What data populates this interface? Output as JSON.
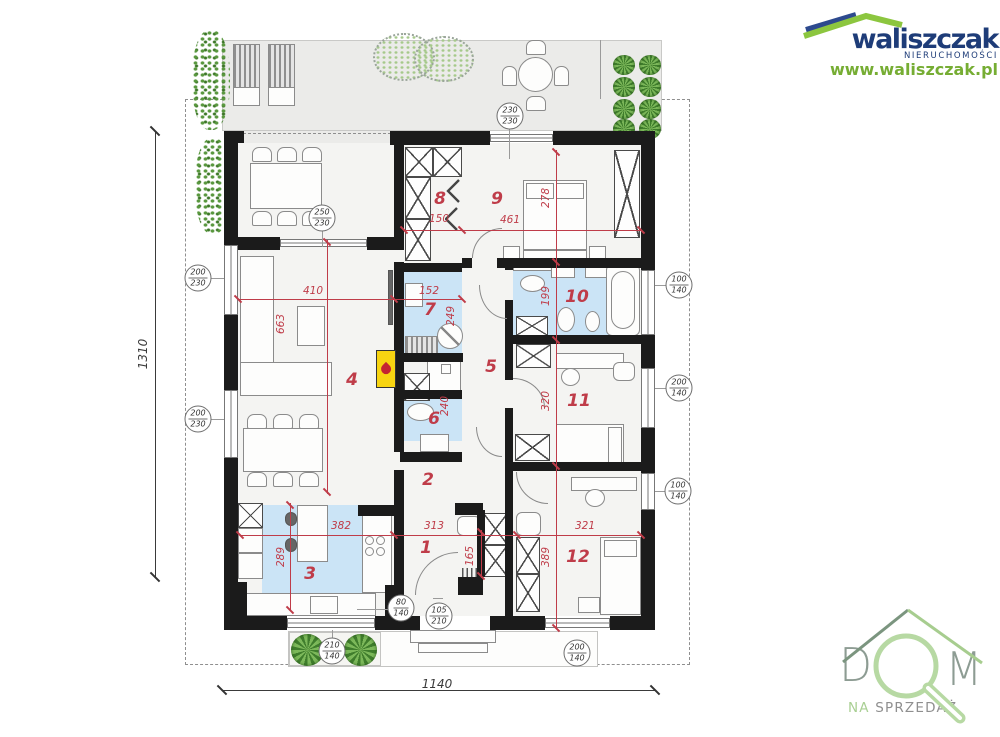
{
  "branding": {
    "name": "waliszczak",
    "tagline": "NIERUCHOMOŚCI",
    "website": "www.waliszczak.pl",
    "colors": {
      "navy": "#1e3c78",
      "green": "#76ad33",
      "roof_blue": "#2d4a8e",
      "roof_green": "#8cc63f"
    }
  },
  "watermark": {
    "letter_d": "D",
    "letter_m": "M",
    "word_na": "NA ",
    "word_sprzedaz": "SPRZEDAŻ",
    "colors": {
      "letters": "#8d9c93",
      "ring": "#b7d9a3",
      "roof_left": "#7b957f",
      "roof_right": "#a7cd8f"
    }
  },
  "plan": {
    "accent_red": "#bf3c49",
    "wet_room_blue": "#cbe4f6",
    "overall": {
      "width_cm": "1140",
      "height_cm": "1310"
    },
    "room_numbers": [
      {
        "n": "1",
        "x": 426,
        "y": 548
      },
      {
        "n": "2",
        "x": 428,
        "y": 480
      },
      {
        "n": "3",
        "x": 310,
        "y": 574
      },
      {
        "n": "4",
        "x": 352,
        "y": 380
      },
      {
        "n": "5",
        "x": 491,
        "y": 367
      },
      {
        "n": "6",
        "x": 434,
        "y": 419
      },
      {
        "n": "7",
        "x": 430,
        "y": 310
      },
      {
        "n": "8",
        "x": 440,
        "y": 199
      },
      {
        "n": "9",
        "x": 497,
        "y": 199
      },
      {
        "n": "10",
        "x": 577,
        "y": 297
      },
      {
        "n": "11",
        "x": 579,
        "y": 401
      },
      {
        "n": "12",
        "x": 578,
        "y": 557
      }
    ],
    "dim_labels": [
      {
        "t": "410",
        "x": 313,
        "y": 291
      },
      {
        "t": "152",
        "x": 429,
        "y": 291
      },
      {
        "t": "150",
        "x": 439,
        "y": 219
      },
      {
        "t": "461",
        "x": 510,
        "y": 220
      },
      {
        "t": "382",
        "x": 341,
        "y": 526
      },
      {
        "t": "313",
        "x": 434,
        "y": 526
      },
      {
        "t": "321",
        "x": 585,
        "y": 526
      },
      {
        "t": "663",
        "x": 281,
        "y": 324,
        "r": 1
      },
      {
        "t": "289",
        "x": 281,
        "y": 557,
        "r": 1
      },
      {
        "t": "278",
        "x": 546,
        "y": 198,
        "r": 1
      },
      {
        "t": "199",
        "x": 546,
        "y": 296,
        "r": 1
      },
      {
        "t": "320",
        "x": 546,
        "y": 401,
        "r": 1
      },
      {
        "t": "389",
        "x": 546,
        "y": 557,
        "r": 1
      },
      {
        "t": "249",
        "x": 451,
        "y": 316,
        "r": 1
      },
      {
        "t": "240",
        "x": 445,
        "y": 406,
        "r": 1
      },
      {
        "t": "165",
        "x": 470,
        "y": 556,
        "r": 1
      },
      {
        "t": "1310",
        "x": 143,
        "y": 354,
        "r": 1,
        "dk": 1
      },
      {
        "t": "1140",
        "x": 437,
        "y": 684,
        "dk": 1
      }
    ],
    "window_markers": [
      {
        "w": "250",
        "h": "230",
        "cx": 322,
        "cy": 218
      },
      {
        "w": "230",
        "h": "230",
        "cx": 510,
        "cy": 116
      },
      {
        "w": "200",
        "h": "230",
        "cx": 198,
        "cy": 278
      },
      {
        "w": "200",
        "h": "230",
        "cx": 198,
        "cy": 419
      },
      {
        "w": "80",
        "h": "140",
        "cx": 401,
        "cy": 608
      },
      {
        "w": "105",
        "h": "210",
        "cx": 439,
        "cy": 616
      },
      {
        "w": "210",
        "h": "140",
        "cx": 332,
        "cy": 651
      },
      {
        "w": "200",
        "h": "140",
        "cx": 577,
        "cy": 653
      },
      {
        "w": "100",
        "h": "140",
        "cx": 679,
        "cy": 285
      },
      {
        "w": "200",
        "h": "140",
        "cx": 679,
        "cy": 388
      },
      {
        "w": "100",
        "h": "140",
        "cx": 678,
        "cy": 491
      }
    ],
    "red_ticks": [
      [
        238,
        299
      ],
      [
        394,
        299
      ],
      [
        462,
        299
      ],
      [
        404,
        230
      ],
      [
        462,
        230
      ],
      [
        641,
        230
      ],
      [
        240,
        535
      ],
      [
        394,
        535
      ],
      [
        517,
        535
      ],
      [
        641,
        535
      ],
      [
        556,
        152
      ],
      [
        556,
        262
      ],
      [
        556,
        340
      ],
      [
        556,
        466
      ],
      [
        556,
        628
      ],
      [
        327,
        242
      ],
      [
        327,
        492
      ],
      [
        290,
        505
      ],
      [
        290,
        610
      ],
      [
        481,
        532
      ],
      [
        481,
        576
      ]
    ],
    "black_ticks": [
      [
        155,
        131
      ],
      [
        155,
        577
      ],
      [
        222,
        690
      ],
      [
        655,
        690
      ]
    ]
  }
}
